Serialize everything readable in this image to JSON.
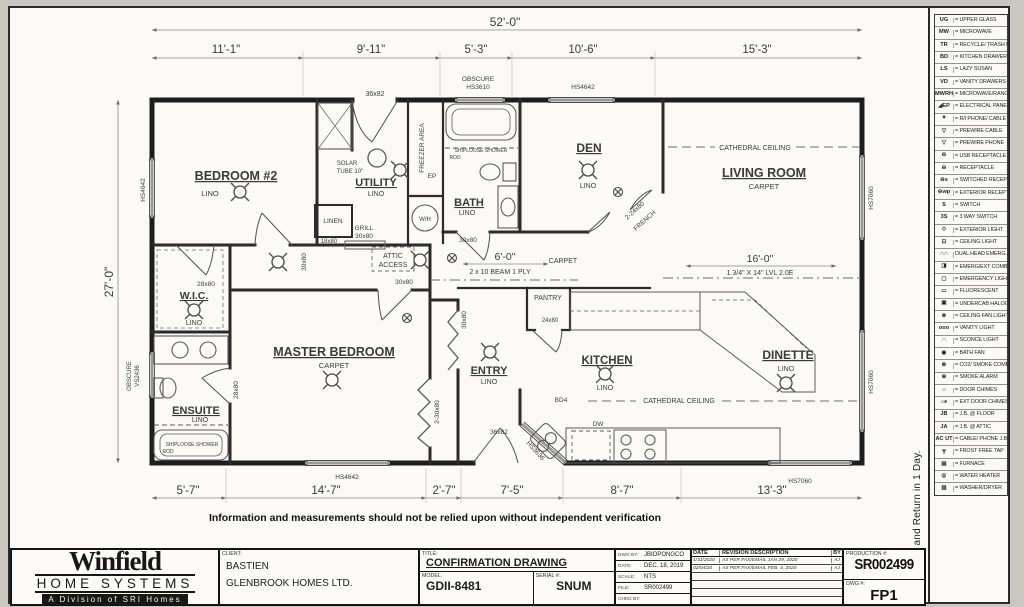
{
  "sheet": {
    "disclaimer": "Information and measurements should not be relied upon without independent verification",
    "sign_note": "Please Sign and Return in 1 Day."
  },
  "plan": {
    "dim_overall": "52'-0\"",
    "dims_top": [
      "11'-1\"",
      "9'-11\"",
      "5'-3\"",
      "10'-6\"",
      "15'-3\""
    ],
    "dim_left": "27'-0\"",
    "dims_bottom": [
      "5'-7\"",
      "14'-7\"",
      "2'-7\"",
      "7'-5\"",
      "8'-7\"",
      "13'-3\""
    ],
    "beam_hall": {
      "len": "6'-0\"",
      "spec": "2 x 10 BEAM 1 PLY"
    },
    "beam_lvl": {
      "len": "16'-0\"",
      "spec": "1 3/4\" X 14\" LVL 2.0E"
    },
    "rooms": {
      "bedroom2": {
        "name": "BEDROOM #2",
        "floor": "LINO"
      },
      "utility": {
        "name": "UTILITY",
        "floor": "LINO"
      },
      "bath": {
        "name": "BATH",
        "floor": "LINO"
      },
      "den": {
        "name": "DEN",
        "floor": "LINO"
      },
      "living": {
        "name": "LIVING ROOM",
        "floor": "CARPET"
      },
      "wic": {
        "name": "W.I.C.",
        "floor": "LINO"
      },
      "ensuite": {
        "name": "ENSUITE",
        "floor": "LINO"
      },
      "master": {
        "name": "MASTER BEDROOM",
        "floor": "CARPET"
      },
      "entry": {
        "name": "ENTRY",
        "floor": "LINO"
      },
      "pantry": {
        "name": "PANTRY"
      },
      "kitchen": {
        "name": "KITCHEN",
        "floor": "LINO"
      },
      "dinette": {
        "name": "DINETTE",
        "floor": "LINO"
      }
    },
    "windows": {
      "top_obscure1": "OBSCURE",
      "top_obscure2": "HS3610",
      "top2": "HS4642",
      "left1": "HS4642",
      "left2a": "OBSCURE",
      "left2b": "VS2436",
      "right1": "HS7060",
      "right2": "HS7060",
      "bottom1": "HS4642",
      "bottom2": "HS7060",
      "entry_bay": "HS3636"
    },
    "doors": {
      "top_utility": "36x82",
      "bed2": "30x80",
      "wic": "28x80",
      "ensuite": "28x80",
      "master": "30x80",
      "bath": "30x80",
      "linen_label": "LINEN",
      "linen": "18x80",
      "grill1": "GRILL",
      "grill2": "30x80",
      "den1": "2-24x80",
      "den2": "FRENCH",
      "pantry": "24x80",
      "entry": "36x82",
      "entry_closet": "30x80",
      "master_closet": "2-30x80"
    },
    "notes": {
      "freezer": "FREEZER AREA",
      "solar1": "SOLAR",
      "solar2": "TUBE 10\"",
      "ep": "EP",
      "wh": "W/H",
      "attic1": "ATTIC",
      "attic2": "ACCESS",
      "cath1": "CATHEDRAL CEILING",
      "cath2": "CATHEDRAL CEILING",
      "carpet_hall": "CARPET",
      "shower_bath1": "SHIPLOOSE SHOWER",
      "shower_bath2": "ROD",
      "shower_ens1": "SHIPLOOSE SHOWER",
      "shower_ens2": "ROD",
      "bd4": "BD4",
      "dw": "DW"
    }
  },
  "legend": {
    "items": [
      {
        "sym": "UG",
        "label": "= UPPER GLASS"
      },
      {
        "sym": "MW",
        "label": "= MICROWAVE"
      },
      {
        "sym": "TR",
        "label": "= RECYCLE/ TRASH BIN"
      },
      {
        "sym": "BD",
        "label": "= KITCHEN DRAWERS"
      },
      {
        "sym": "LS",
        "label": "= LAZY SUSAN"
      },
      {
        "sym": "VD",
        "label": "= VANITY DRAWERS"
      },
      {
        "sym": "MWRH",
        "label": "= MICROWAVE/RANGEHOOD"
      },
      {
        "sym": "◢EP",
        "label": "= ELECTRICAL PANEL"
      },
      {
        "sym": "▼",
        "label": "= R/I PHONE/ CABLE"
      },
      {
        "sym": "▽",
        "label": "= PREWIRE CABLE"
      },
      {
        "sym": "▽",
        "label": "= PREWIRE PHONE"
      },
      {
        "sym": "⊖",
        "label": "= USB RECEPTACLE"
      },
      {
        "sym": "⊖",
        "label": "= RECEPTACLE"
      },
      {
        "sym": "⊖s",
        "label": "= SWITCHED RECEPT."
      },
      {
        "sym": "⊖wp",
        "label": "= EXTERIOR RECEPT."
      },
      {
        "sym": "S",
        "label": "= SWITCH"
      },
      {
        "sym": "3S",
        "label": "= 3 WAY SWITCH"
      },
      {
        "sym": "◇",
        "label": "= EXTERIOR LIGHT"
      },
      {
        "sym": "⊡",
        "label": "= CEILING LIGHT"
      },
      {
        "sym": "∩∩",
        "label": "DUAL HEAD EMERG."
      },
      {
        "sym": "◨",
        "label": "= EMERG/EXT COMBO"
      },
      {
        "sym": "▢",
        "label": "= EMERGENCY LIGHT"
      },
      {
        "sym": "▭",
        "label": "= FLUORESCENT"
      },
      {
        "sym": "▣",
        "label": "= UNDERCAB HALOGEN"
      },
      {
        "sym": "⊗",
        "label": "= CEILING FAN LIGHT COMBO."
      },
      {
        "sym": "ooo",
        "label": "= VANITY LIGHT"
      },
      {
        "sym": "∩",
        "label": "= SCONCE LIGHT"
      },
      {
        "sym": "◉",
        "label": "= BATH FAN"
      },
      {
        "sym": "⊛",
        "label": "= CO2/ SMOKE COMBO"
      },
      {
        "sym": "⊕",
        "label": "= SMOKE ALARM"
      },
      {
        "sym": "⌂",
        "label": "= DOOR CHIMES"
      },
      {
        "sym": "⌂e",
        "label": "= EXT DOOR CHIMES"
      },
      {
        "sym": "JB",
        "label": "= J.B. @ FLOOR"
      },
      {
        "sym": "JA",
        "label": "= J.B. @ ATTIC"
      },
      {
        "sym": "AC UT",
        "label": "= CABLE/ PHONE J.B"
      },
      {
        "sym": "┳",
        "label": "= FROST FREE TAP"
      },
      {
        "sym": "▤",
        "label": "= FURNACE"
      },
      {
        "sym": "◎",
        "label": "= WATER HEATER"
      },
      {
        "sym": "▥",
        "label": "= WASHER/DRYER"
      }
    ]
  },
  "titleblock": {
    "logo_name": "Winfield",
    "logo_sub": "HOME SYSTEMS",
    "logo_tag": "A Division of SRI Homes",
    "client_label": "CLIENT:",
    "client_line1": "BASTIEN",
    "client_line2": "GLENBROOK HOMES LTD.",
    "title_label": "TITLE:",
    "title": "CONFIRMATION DRAWING",
    "model_label": "MODEL:",
    "model": "GDII-8481",
    "serial_label": "SERIAL #:",
    "serial": "SNUM",
    "dwgby_label": "DWG BY:",
    "dwgby": "JBIOPONGCO",
    "date_label": "DATE:",
    "date": "DEC. 18, 2019",
    "scale_label": "SCALE:",
    "scale": "NTS",
    "file_label": "FILE:",
    "file": "SR002499",
    "chkd_label": "CHKD BY:",
    "chkd": "",
    "rev_h_date": "DATE",
    "rev_h_desc": "REVISION DESCRIPTION",
    "rev_h_by": "BY",
    "revisions": [
      {
        "date": "1/31/2020",
        "desc": "AS PER FAX/EMAIL  JAN 29, 2020",
        "by": "AJ"
      },
      {
        "date": "02/04/20",
        "desc": "AS PER FAX/EMAIL FEB. 4, 2020",
        "by": "AJ"
      }
    ],
    "production_label": "PRODUCTION #:",
    "production": "SR002499",
    "dwg_label": "DWG #:",
    "dwg": "FP1"
  }
}
